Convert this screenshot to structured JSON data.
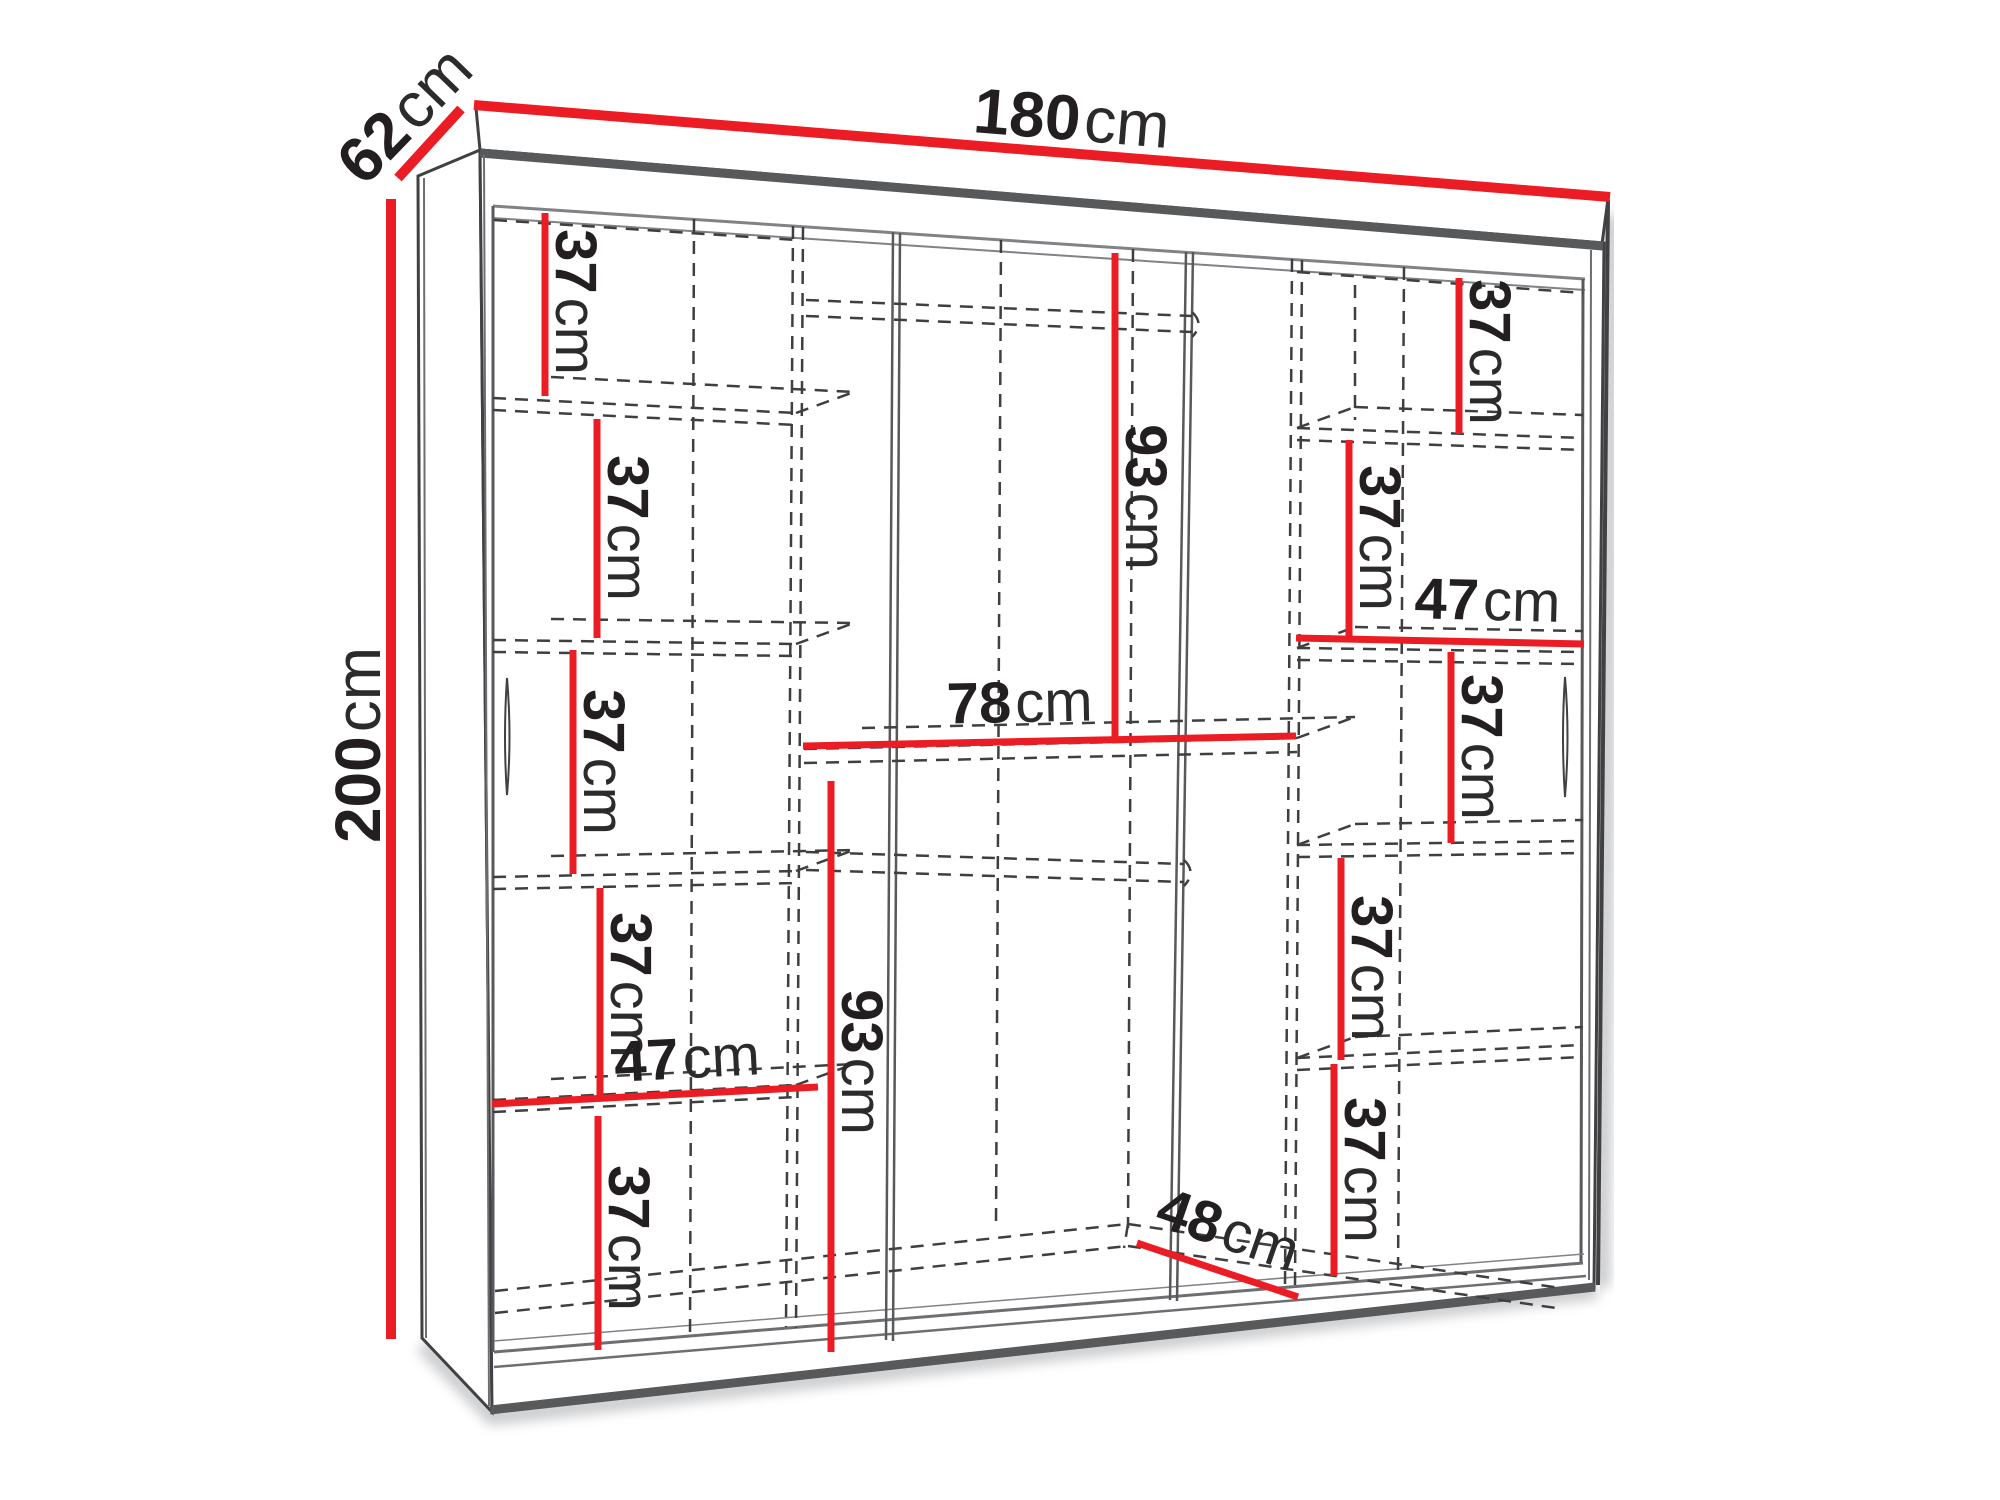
{
  "diagram": {
    "type": "wardrobe-dimension-drawing",
    "unit": "cm",
    "colors": {
      "dimension_line": "#ec1c24",
      "outline": "#414042",
      "dashed": "#3f3f40",
      "text": "#231f20",
      "background": "#ffffff"
    },
    "dims": {
      "width": {
        "value": "180",
        "unit": "cm"
      },
      "depth": {
        "value": "62",
        "unit": "cm"
      },
      "height": {
        "value": "200",
        "unit": "cm"
      },
      "left_shelf_1": {
        "value": "37",
        "unit": "cm"
      },
      "left_shelf_2": {
        "value": "37",
        "unit": "cm"
      },
      "left_shelf_3": {
        "value": "37",
        "unit": "cm"
      },
      "left_shelf_4": {
        "value": "37",
        "unit": "cm"
      },
      "left_shelf_5": {
        "value": "37",
        "unit": "cm"
      },
      "left_width": {
        "value": "47",
        "unit": "cm"
      },
      "middle_upper_height": {
        "value": "93",
        "unit": "cm"
      },
      "middle_width": {
        "value": "78",
        "unit": "cm"
      },
      "middle_lower_height": {
        "value": "93",
        "unit": "cm"
      },
      "middle_depth": {
        "value": "48",
        "unit": "cm"
      },
      "right_shelf_1": {
        "value": "37",
        "unit": "cm"
      },
      "right_shelf_2": {
        "value": "37",
        "unit": "cm"
      },
      "right_shelf_3": {
        "value": "37",
        "unit": "cm"
      },
      "right_shelf_4": {
        "value": "37",
        "unit": "cm"
      },
      "right_shelf_5": {
        "value": "37",
        "unit": "cm"
      },
      "right_width": {
        "value": "47",
        "unit": "cm"
      }
    }
  }
}
